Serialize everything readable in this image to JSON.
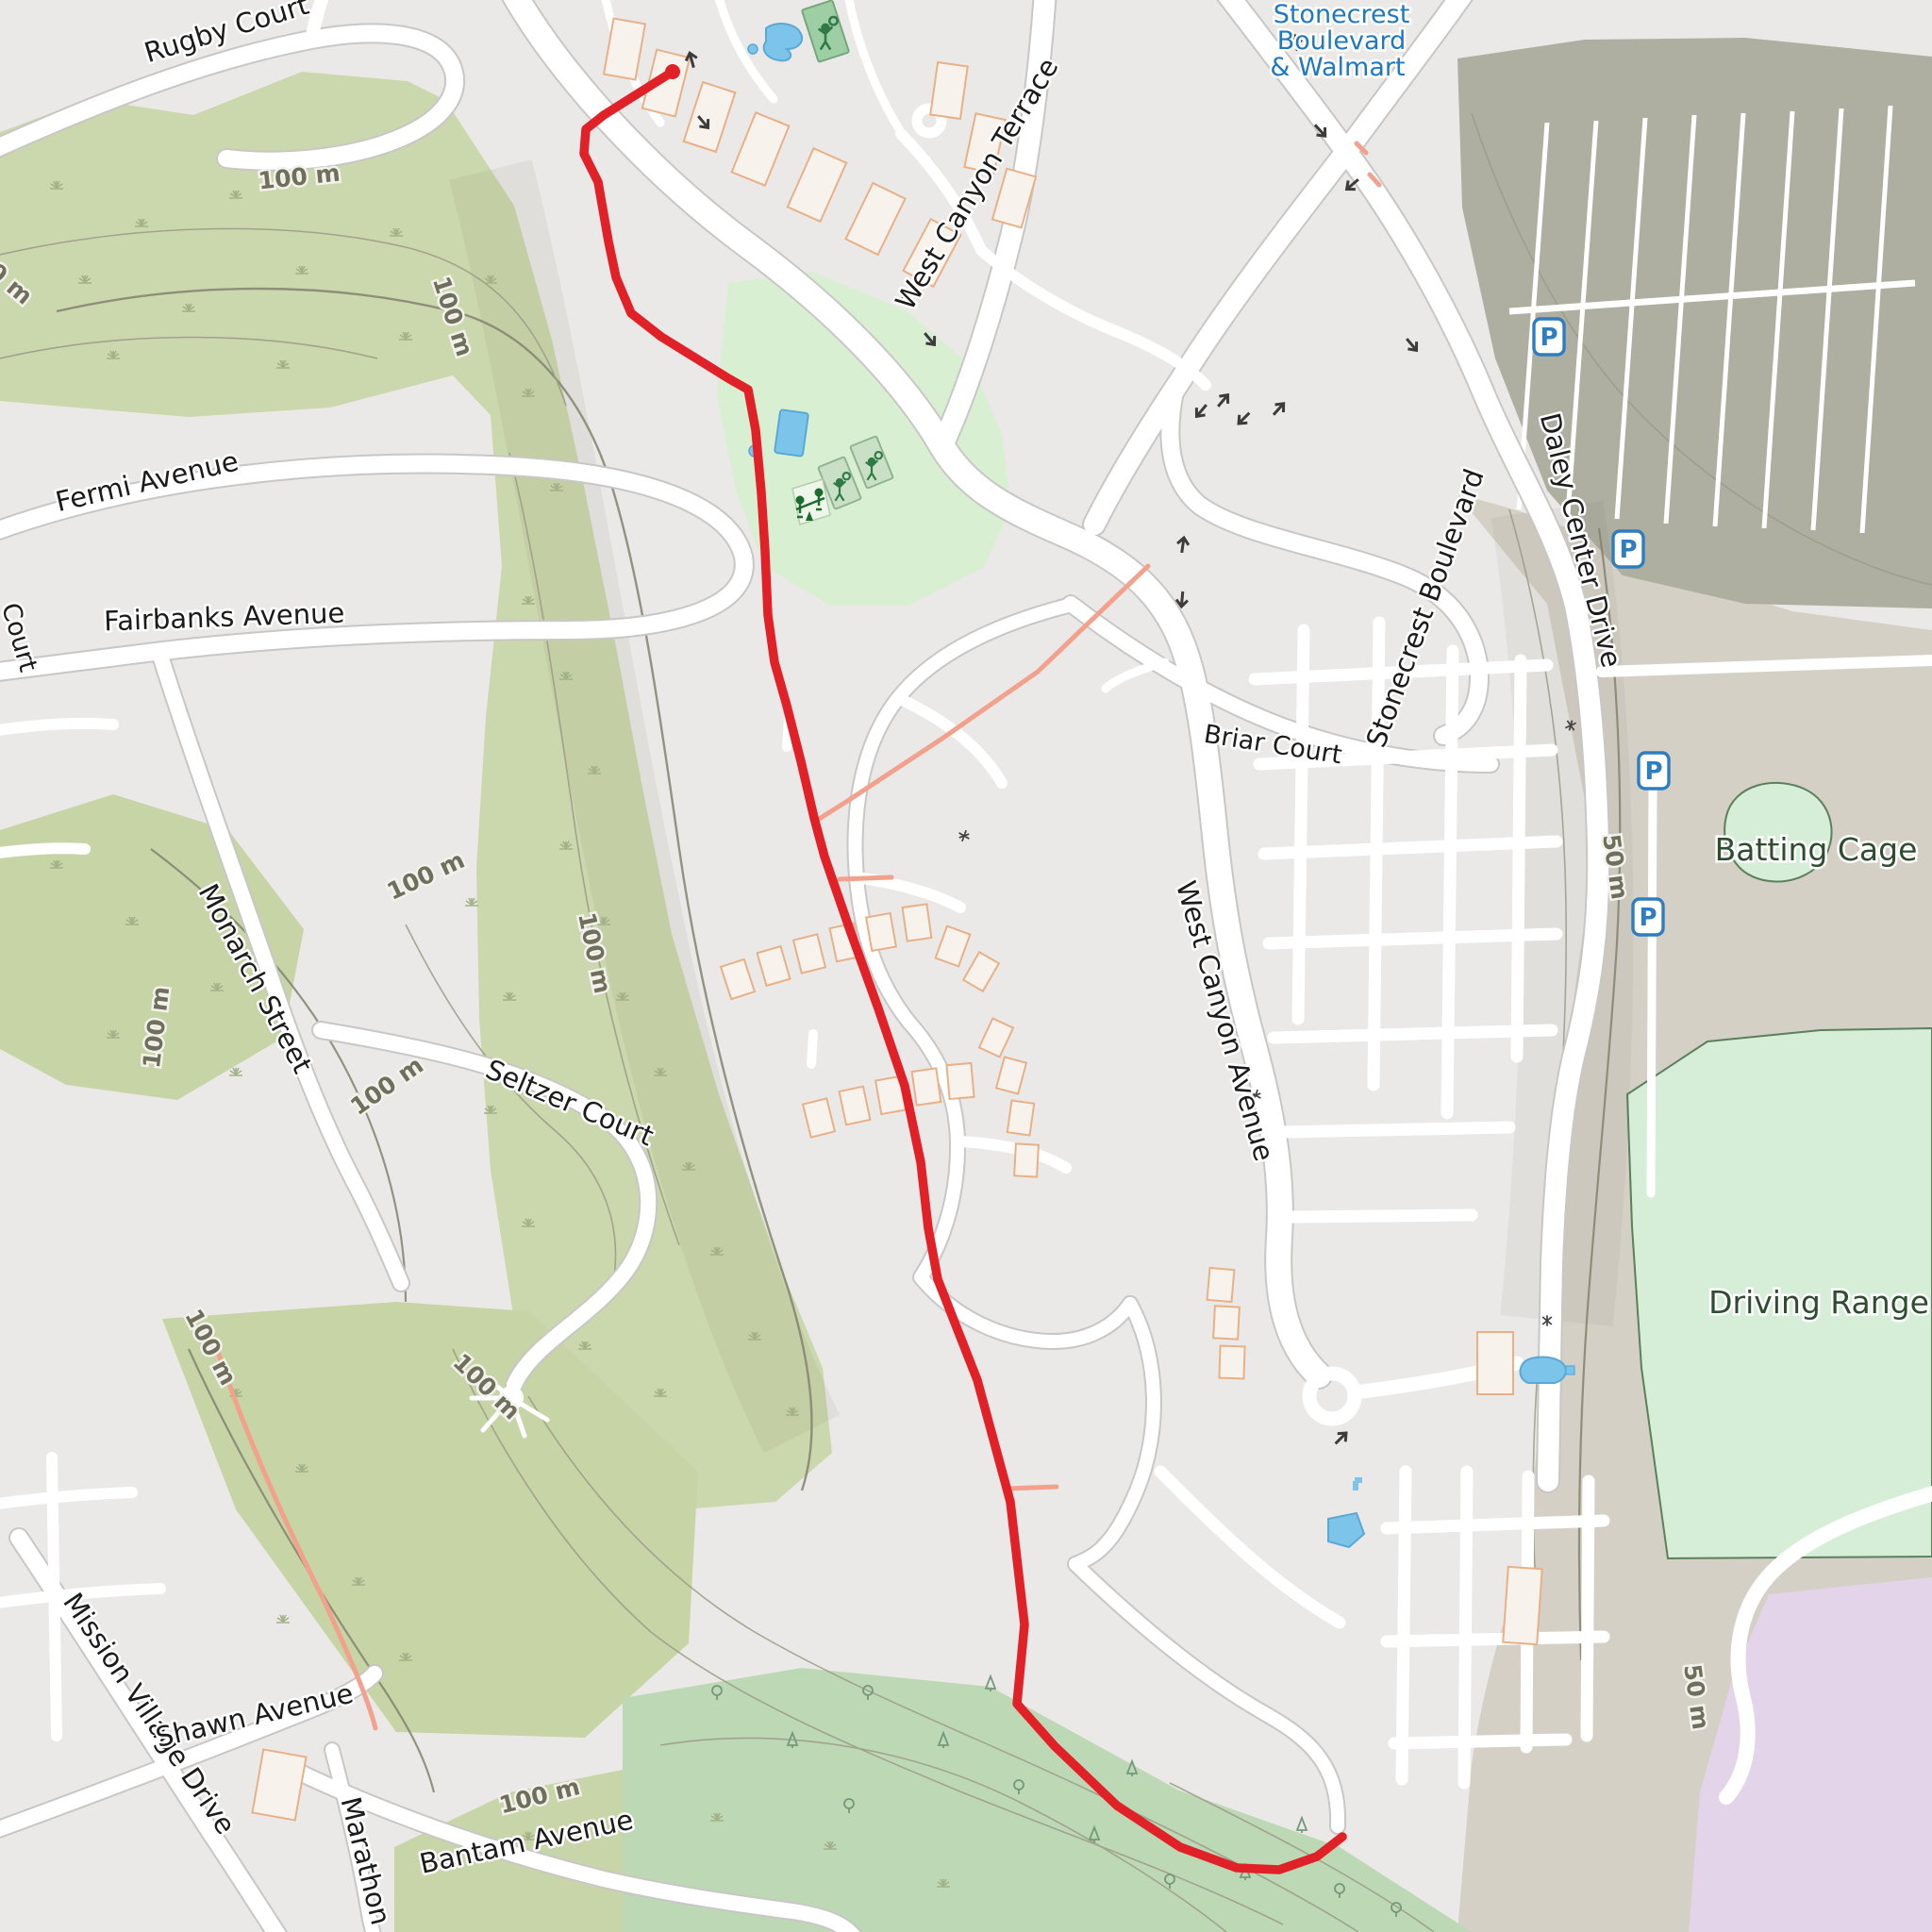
{
  "map": {
    "route": {
      "color": "#e02228",
      "description": "gps-track-red-line"
    },
    "labels": {
      "streets": [
        {
          "text": "Rugby Court"
        },
        {
          "text": "Fermi Avenue"
        },
        {
          "text": "Fairbanks Avenue"
        },
        {
          "text": "Monarch Street"
        },
        {
          "text": "Seltzer Court"
        },
        {
          "text": "Mission Village Drive"
        },
        {
          "text": "Shawn Avenue"
        },
        {
          "text": "Marathon"
        },
        {
          "text": "Bantam Avenue"
        },
        {
          "text": "West Canyon Terrace"
        },
        {
          "text": "West Canyon Avenue"
        },
        {
          "text": "Briar Court"
        },
        {
          "text": "Stonecrest Boulevard"
        },
        {
          "text": "Daley Center Drive"
        },
        {
          "text": "Court"
        }
      ],
      "contours": [
        {
          "text": "100 m"
        },
        {
          "text": "100 m"
        },
        {
          "text": "100 m"
        },
        {
          "text": "100 m"
        },
        {
          "text": "100 m"
        },
        {
          "text": "100 m"
        },
        {
          "text": "100 m"
        },
        {
          "text": "100 m"
        },
        {
          "text": "100 m"
        },
        {
          "text": "100 m"
        },
        {
          "text": "50 m"
        },
        {
          "text": "50 m"
        }
      ],
      "pois": [
        {
          "text": "Batting Cage"
        },
        {
          "text": "Driving Range"
        }
      ],
      "transit_stop": {
        "line1": "Stonecrest",
        "line2": "Boulevard",
        "line3": "& Walmart"
      },
      "parking_letter": "P"
    },
    "colors": {
      "route_red": "#e02228",
      "road_fill": "#ffffff",
      "road_casing": "#c9c7c5",
      "base_gray": "#ebe9e7",
      "scrub_green": "#cbd7ac",
      "forest_green": "#bdd8b4",
      "park_mint": "#d8efd2",
      "range_mint": "#d6edd8",
      "campus_purple": "#e4d4e9",
      "parking_olive": "#aeafa0",
      "taupe_band": "#d4d0c5",
      "water_blue": "#7cc4ea",
      "parking_blue": "#2e7dc0",
      "path_pink": "#f2a18c",
      "contour_gray": "#9b9b87"
    }
  }
}
